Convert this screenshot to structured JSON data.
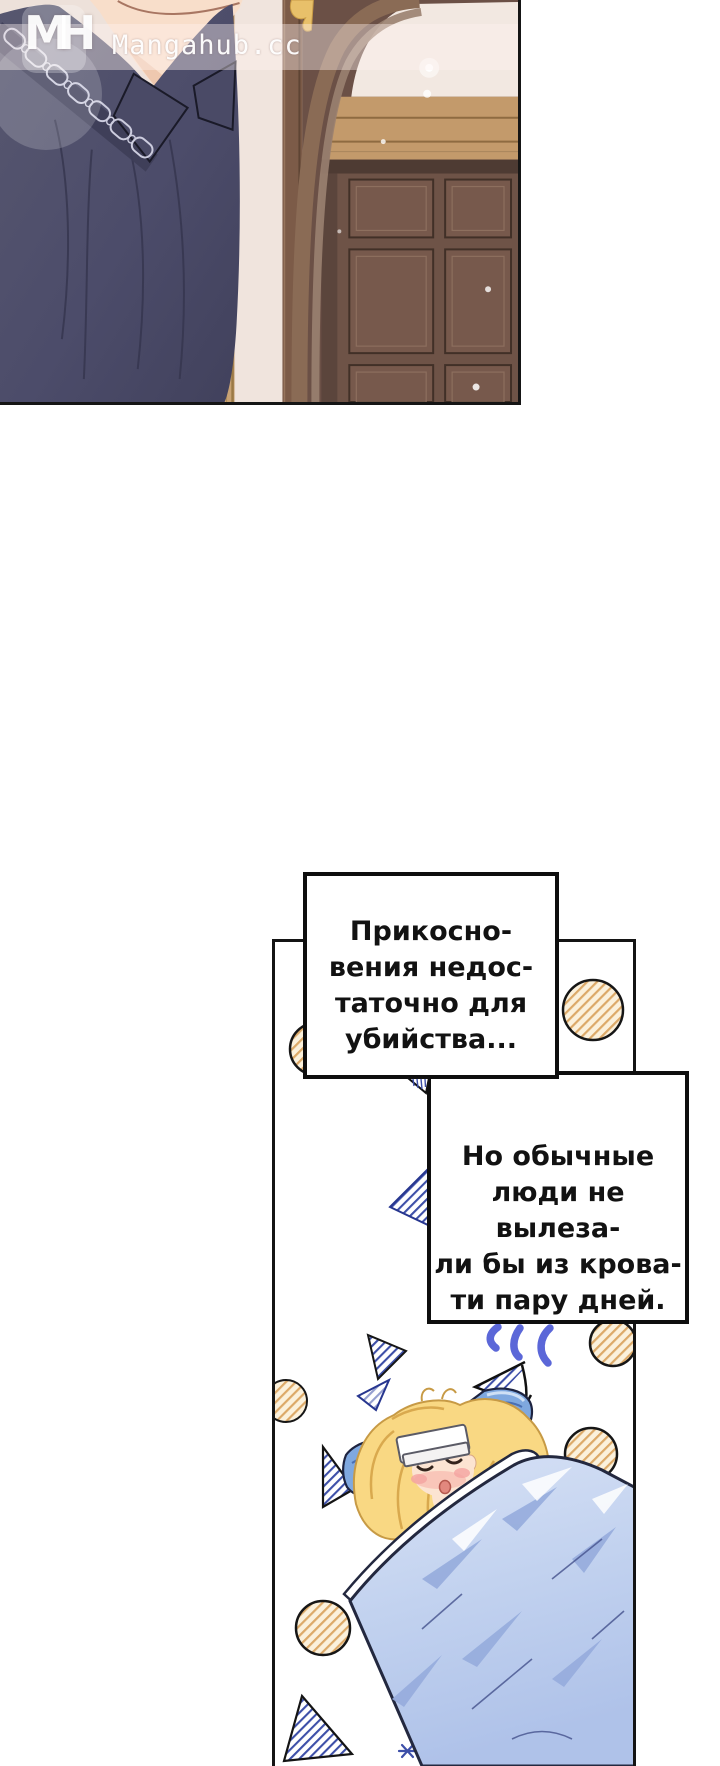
{
  "site_watermark": {
    "logo_text": "MH",
    "site_name": "Mangahub.cc"
  },
  "speech_bubbles": [
    {
      "lines": [
        "Прикосно-",
        "вения недос-",
        "таточно для",
        "убийства..."
      ]
    },
    {
      "lines": [
        "Но обычные",
        "люди не вылеза-",
        "ли бы из крова-",
        "ти пару дней."
      ]
    }
  ],
  "panels": [
    {
      "name": "hallway-panel",
      "alt": "Man in a navy shirt with chain-embroidered collar standing beside an arched wooden door"
    },
    {
      "name": "bedroom-panel",
      "alt": "Feverish blonde girl asleep under a blue blanket with a compress on her forehead"
    }
  ],
  "colors": {
    "shirt_navy": "#4C4C6A",
    "wall_cream": "#EDE1DA",
    "door_brown": "#6B5046",
    "lintel_tan": "#C39A6B",
    "blanket_blue": "#C2D2EF",
    "pillow_blue": "#7FA8DF",
    "hair_gold": "#F9D883",
    "hatch_tan": "#DCA968",
    "hatch_blue": "#3D4FA8",
    "squiggle_blue": "#5B67D8"
  }
}
